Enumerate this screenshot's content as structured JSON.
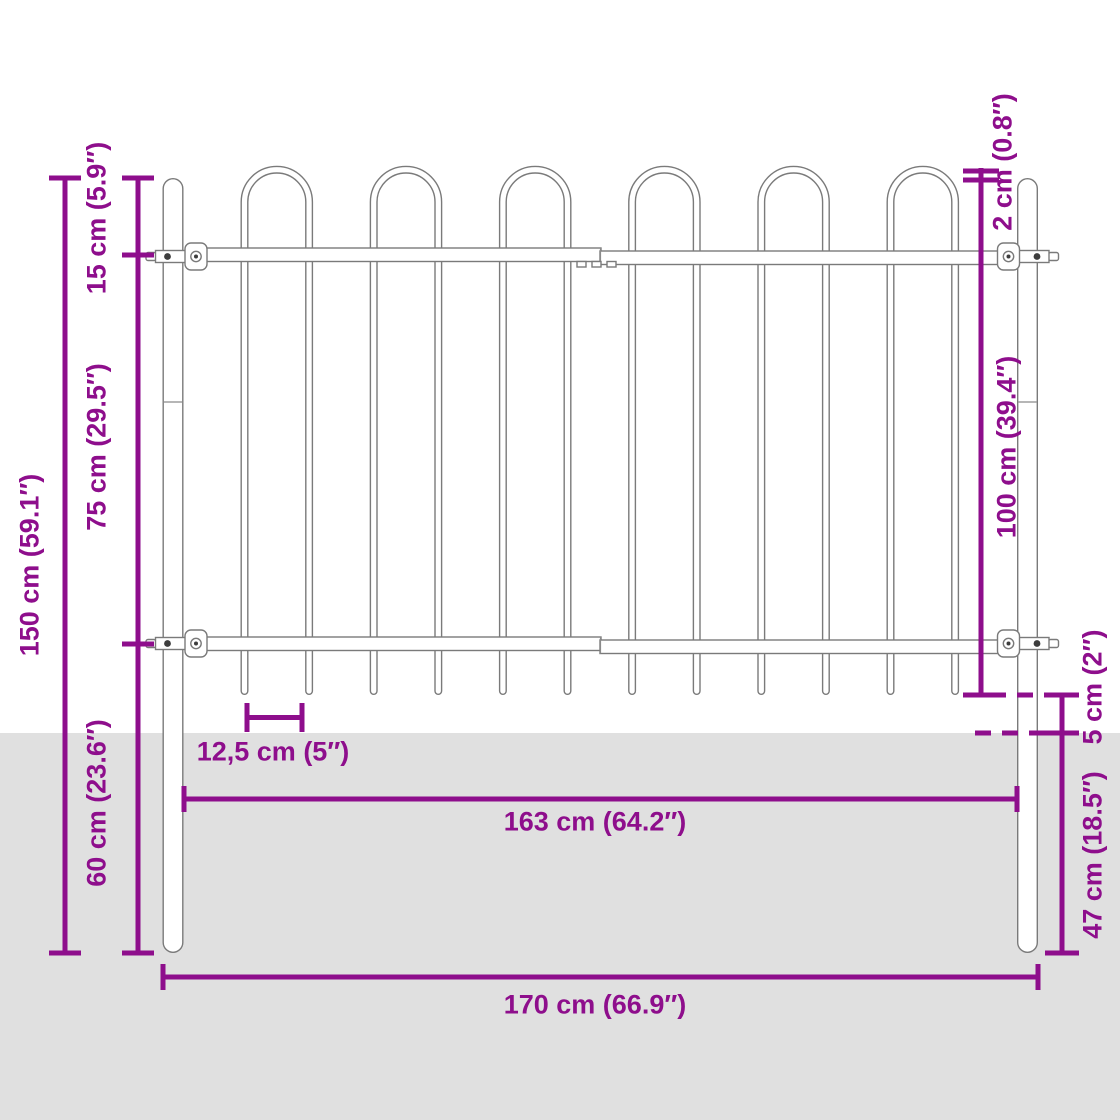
{
  "diagram": {
    "subject": "Steel garden fence panel with hoop top, two round posts and purple dimension annotations",
    "colors": {
      "dimension_accent": "#8E0E8C",
      "ground": "#E0E0E0",
      "fence_outline": "#7A7A7A",
      "background": "#FFFFFF"
    },
    "structure": {
      "hoops": 6,
      "vertical_bars": 12,
      "posts": 2,
      "horizontal_rails": 2
    },
    "dimensions": {
      "total_height": "150 cm (59.1″)",
      "post_top_to_top_rail": "15 cm (5.9″)",
      "rail_to_rail": "75 cm (29.5″)",
      "ground_section_height": "60 cm (23.6″)",
      "hoop_above_post": "2 cm (0.8″)",
      "panel_height": "100 cm (39.4″)",
      "bar_tip_clearance": "5 cm (2″)",
      "post_depth_below_ground": "47 cm (18.5″)",
      "bar_spacing": "12,5 cm (5″)",
      "inner_width": "163 cm (64.2″)",
      "total_width": "170 cm (66.9″)"
    }
  }
}
